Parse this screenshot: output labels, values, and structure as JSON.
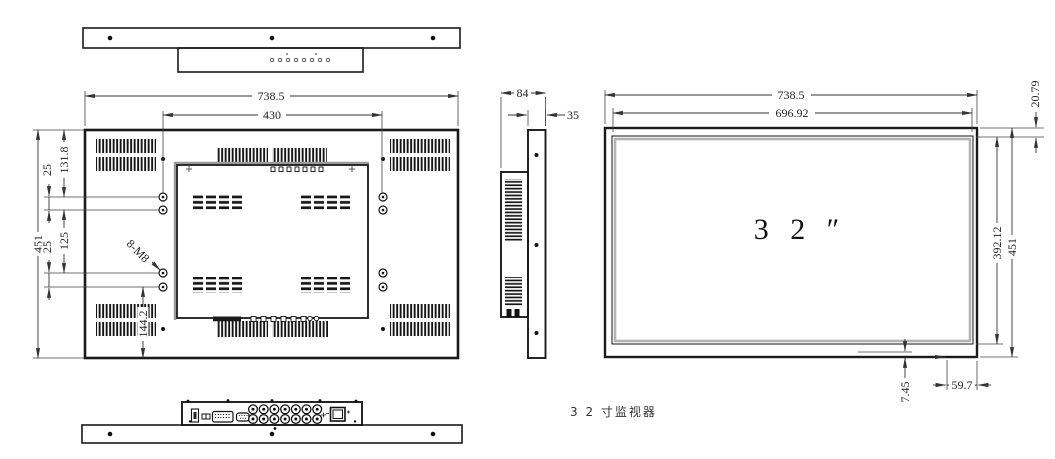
{
  "caption": "3 2 寸监视器",
  "rear": {
    "overall_width": "738.5",
    "vesa_width": "430",
    "overall_height": "451",
    "top_edge_to_holes": "131.8",
    "hole_pitch_top": "25",
    "vesa_height": "125",
    "hole_pitch_bottom": "25",
    "holes_to_bottom": "144.2",
    "thread_callout": "8-M8"
  },
  "side": {
    "overall_depth": "84",
    "panel_depth": "35"
  },
  "front": {
    "overall_width": "738.5",
    "display_width": "696.92",
    "top_margin": "20.79",
    "display_height": "392.12",
    "overall_height": "451",
    "bottom_inset": "7.45",
    "corner_offset": "59.7",
    "screen_size": "3 2 ″"
  }
}
